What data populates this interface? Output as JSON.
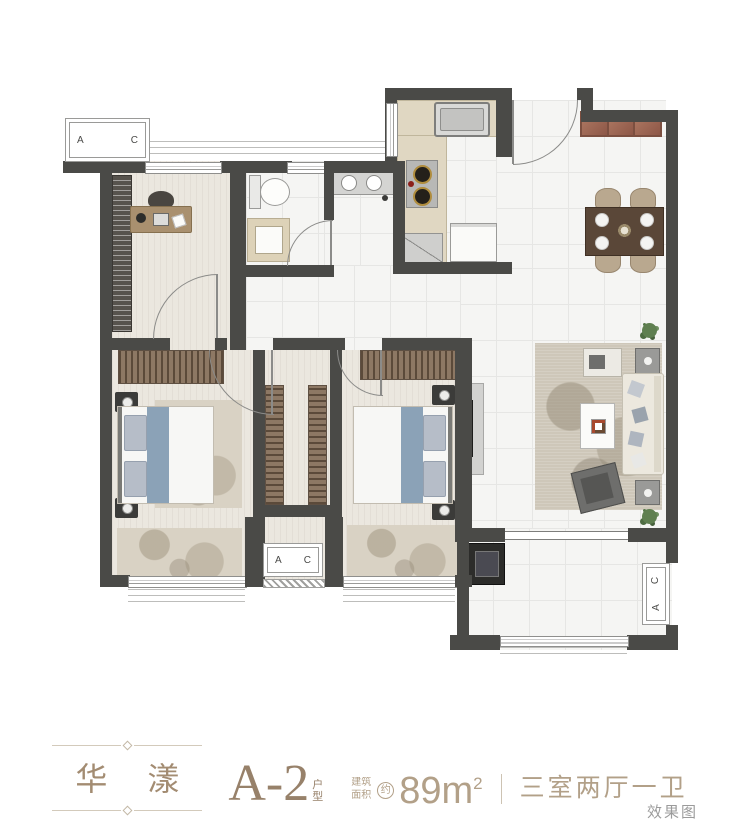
{
  "plan": {
    "ac_unit": {
      "letter_a": "A",
      "letter_c": "C"
    },
    "colors": {
      "wall": "#4a4a47",
      "wood_floor": "#ebe7df",
      "tile_floor": "#f5f5f3",
      "wardrobe": "#8d7864",
      "bed_accent": "#8ba2b7",
      "entry_bench": "#a06a58",
      "legend_brown": "#97816a",
      "legend_light_brown": "#b2a088"
    }
  },
  "legend": {
    "project_name": "华 漾",
    "unit_code": "A-2",
    "unit_type_label": "户型",
    "area_label": "建筑面积",
    "area_approx_label": "约",
    "area_value": "89m",
    "area_exponent": "2",
    "layout_description": "三室两厅一卫"
  },
  "watermark": "效果图"
}
